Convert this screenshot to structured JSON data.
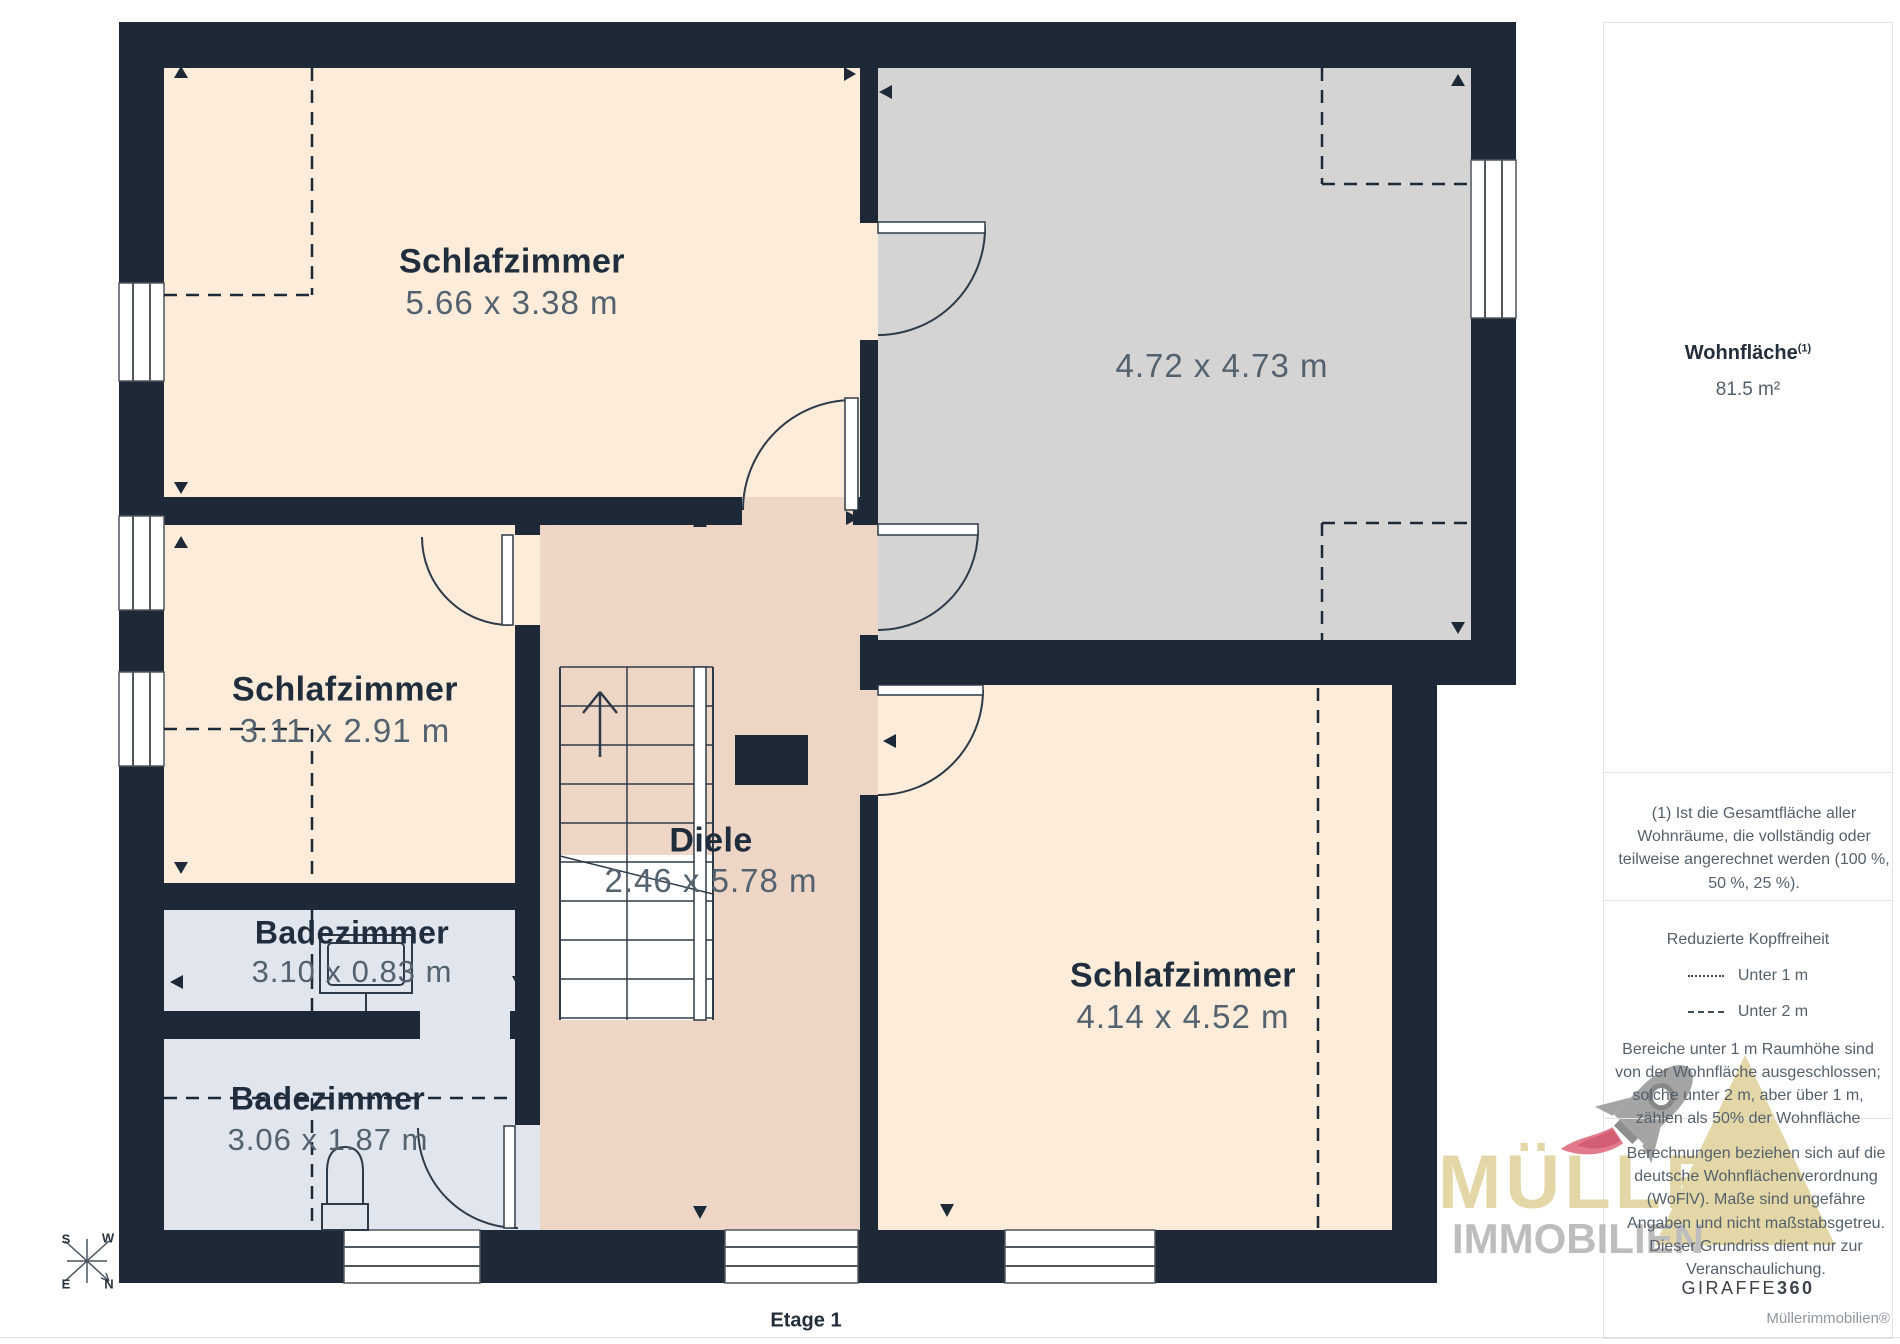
{
  "floor_plan": {
    "floor_label": "Etage 1",
    "rooms": [
      {
        "name": "Schlafzimmer",
        "dims": "5.66 x 3.38 m"
      },
      {
        "name": "",
        "dims": "4.72 x 4.73 m"
      },
      {
        "name": "Schlafzimmer",
        "dims": "3.11 x 2.91 m"
      },
      {
        "name": "Diele",
        "dims": "2.46 x 5.78 m"
      },
      {
        "name": "Badezimmer",
        "dims": "3.10 x 0.83 m"
      },
      {
        "name": "Badezimmer",
        "dims": "3.06 x 1.87 m"
      },
      {
        "name": "Schlafzimmer",
        "dims": "4.14 x 4.52 m"
      }
    ],
    "compass": {
      "n": "N",
      "e": "E",
      "s": "S",
      "w": "W"
    }
  },
  "sidebar": {
    "area": {
      "label": "Wohnfläche",
      "sup": "(1)",
      "value": "81.5 m²"
    },
    "footnote": "(1) Ist die Gesamtfläche aller Wohnräume, die vollständig oder teilweise angerechnet werden (100 %, 50 %, 25 %).",
    "headroom": {
      "title": "Reduzierte Kopffreiheit",
      "items": [
        {
          "line_style": "dotted",
          "label": "Unter 1 m"
        },
        {
          "line_style": "dashed",
          "label": "Unter 2 m"
        }
      ],
      "note": "Bereiche unter 1 m Raumhöhe sind von der Wohnfläche ausgeschlossen; solche unter 2 m, aber über 1 m, zählen als 50% der Wohnfläche"
    },
    "disclaimer": "Berechnungen beziehen sich auf die deutsche Wohnflächenverordnung (WoFlV). Maße sind ungefähre Angaben und nicht maßstabsgetreu. Dieser Grundriss dient nur zur Veranschaulichung.",
    "brand": {
      "name": "GIRAFFE",
      "suffix": "360"
    },
    "credit": "Müllerimmobilien®"
  },
  "watermark": {
    "line1": "MÜLLER",
    "line2": "IMMOBILIEN"
  },
  "colors": {
    "wall": "#1d2936",
    "room": "#fdecd9",
    "hall": "#eed6c6",
    "bath": "#e1e5ee",
    "excluded_room": "#d4d4d4",
    "title_text": "#1f2d3c",
    "dims_text": "#54626f",
    "watermark_gold": "#e4d7a7",
    "watermark_gray": "#bdbdbd",
    "rocket_red": "#e27a8b"
  }
}
